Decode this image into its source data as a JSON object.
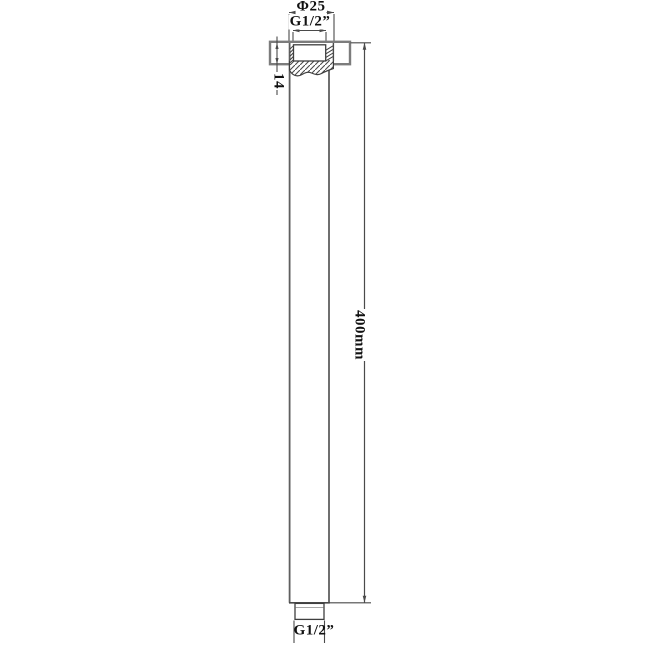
{
  "drawing": {
    "title": "Ceiling shower arm technical drawing",
    "labels": {
      "diameter_top": "Φ25",
      "thread_top": "G1/2”",
      "flange_height": "14",
      "arm_length": "400mm",
      "thread_bottom": "G1/2”"
    },
    "dimensions": [
      {
        "name": "outer-diameter",
        "value": 25,
        "unit": "mm",
        "label": "Φ25"
      },
      {
        "name": "top-thread",
        "value": "G1/2",
        "unit": "inch",
        "label": "G1/2”"
      },
      {
        "name": "flange-height",
        "value": 14,
        "unit": "mm",
        "label": "14"
      },
      {
        "name": "arm-length",
        "value": 400,
        "unit": "mm",
        "label": "400mm"
      },
      {
        "name": "bottom-thread",
        "value": "G1/2",
        "unit": "inch",
        "label": "G1/2”"
      }
    ],
    "colors": {
      "background": "#ffffff",
      "outline_dark": "#3f3f3f",
      "tube_line": "#5f5f5f",
      "flange_line": "#7c7c7c",
      "dimension_line": "#4a4a4a",
      "text": "#111111"
    }
  }
}
